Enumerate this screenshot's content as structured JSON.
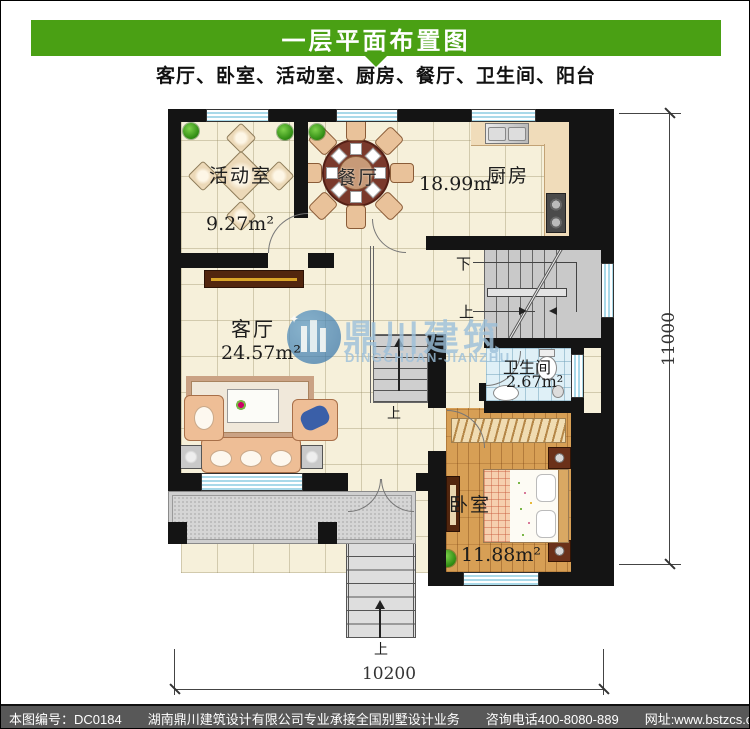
{
  "page": {
    "title": "一层平面布置图",
    "subtitle": "客厅、卧室、活动室、厨房、餐厅、卫生间、阳台",
    "accent_green": "#4aa014",
    "footer_bg": "#585858"
  },
  "rooms": {
    "activity": {
      "name": "活动室",
      "area": "9.27m²"
    },
    "dining": {
      "name": "餐厅"
    },
    "kitchen": {
      "name": "厨房",
      "area": "18.99m²"
    },
    "living": {
      "name": "客厅",
      "area": "24.57m²"
    },
    "bath": {
      "name": "卫生间",
      "area": "2.67m²"
    },
    "bedroom": {
      "name": "卧室",
      "area": "11.88m²"
    }
  },
  "stairs": {
    "down": "下",
    "up": "上"
  },
  "dimensions": {
    "horizontal": "10200",
    "vertical": "11000"
  },
  "watermark": {
    "cn": "鼎川建筑",
    "en": "DINGCHUAN-JIANZHU"
  },
  "footer": {
    "sheet_no": "本图编号：DC0184",
    "company": "湖南鼎川建筑设计有限公司专业承接全国别墅设计业务",
    "phone": "咨询电话400-8080-889",
    "website": "网址:www.bstzcs.com"
  }
}
